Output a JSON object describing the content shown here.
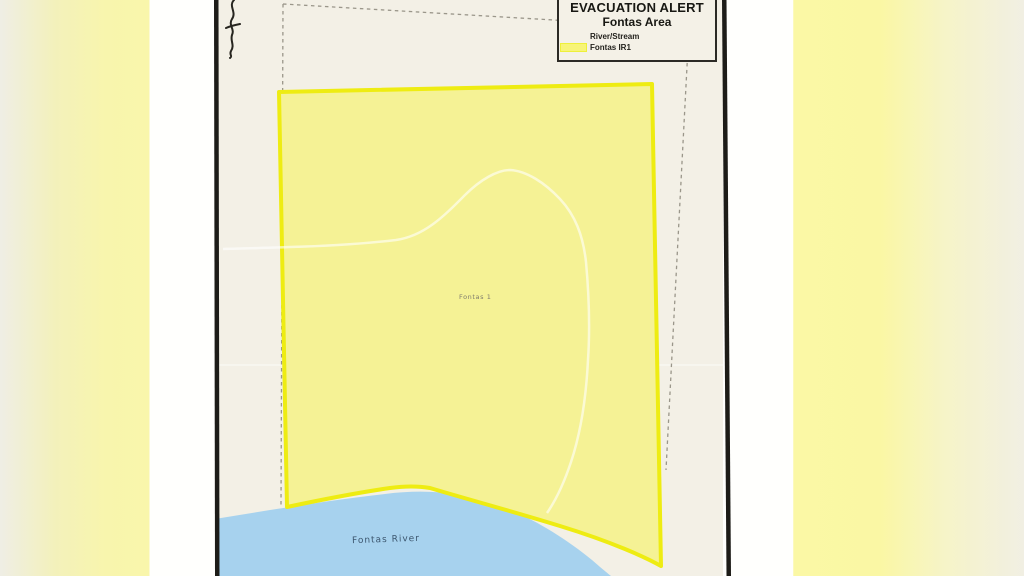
{
  "legend": {
    "title": "EVACUATION ALERT",
    "subtitle": "Fontas Area",
    "items": [
      {
        "label": "River/Stream"
      },
      {
        "label": "Fontas IR1",
        "swatch_color": "#f7f478"
      }
    ]
  },
  "map": {
    "area_label": "Fontas 1",
    "river_label": "Fontas River",
    "colors": {
      "paper_inner": "#f3f0e6",
      "reserve_fill": "#f5f295",
      "reserve_border": "#eeec12",
      "river_fill": "#a7d2ee",
      "dashed_boundary": "#9a968a",
      "frame_border": "#1d1c18"
    }
  }
}
